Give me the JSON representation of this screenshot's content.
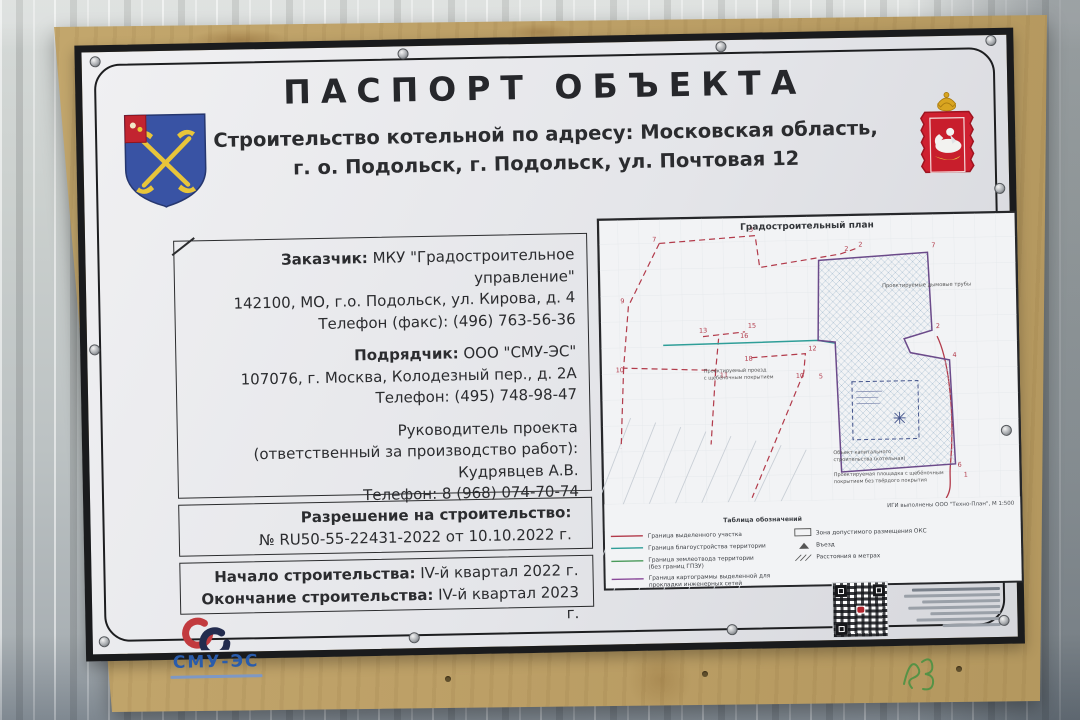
{
  "banner": {
    "title": "ПАСПОРТ ОБЪЕКТА",
    "subtitle_line1": "Строительство котельной по адресу: Московская область,",
    "subtitle_line2": "г. о. Подольск, г. Подольск, ул. Почтовая 12"
  },
  "info": {
    "customer": {
      "label": "Заказчик:",
      "name": "МКУ \"Градостроительное управление\"",
      "address": "142100, МО, г.о. Подольск, ул. Кирова, д. 4",
      "phone": "Телефон (факс): (496) 763-56-36"
    },
    "contractor": {
      "label": "Подрядчик:",
      "name": "ООО \"СМУ-ЭС\"",
      "address": "107076, г. Москва, Колодезный пер., д. 2А",
      "phone": "Телефон: (495) 748-98-47"
    },
    "manager": {
      "line1": "Руководитель проекта",
      "line2": "(ответственный за производство работ):",
      "name": "Кудрявцев А.В.",
      "phone": "Телефон: 8 (968) 074-70-74"
    },
    "permit": {
      "label": "Разрешение на строительство:",
      "value": "№ RU50-55-22431-2022 от 10.10.2022 г."
    },
    "dates": {
      "start_label": "Начало строительства:",
      "start_value": "IV-й квартал 2022 г.",
      "end_label": "Окончание строительства:",
      "end_value": "IV-й квартал 2023 г."
    }
  },
  "plan": {
    "title": "Градостроительный план",
    "note_right": "Проектируемые дымовые трубы",
    "note_road_1": "Проектируемый проезд",
    "note_road_2": "с щебёночным покрытием",
    "note_object_1": "Объект капитального",
    "note_object_2": "строительства (котельная)",
    "note_area_1": "Проектируемая площадка с щебёночным",
    "note_area_2": "покрытием без твёрдого покрытия",
    "scale_note": "ИГИ выполнены ООО \"Техно-План\", М 1:500",
    "legend": {
      "header": "Таблица обозначений",
      "item1": "Граница выделенного участка",
      "item2": "Граница благоустройства территории",
      "item3a": "Граница землеотвода территории",
      "item3b": "(без границ ГПЗУ)",
      "item4a": "Граница картограммы выделенной для",
      "item4b": "прокладки инженерных сетей",
      "right1": "Зона допустимого размещения ОКС",
      "right2": "Въезд",
      "right3": "Расстояния в метрах"
    },
    "points": [
      "7",
      "3",
      "2",
      "2",
      "9",
      "15",
      "16",
      "13",
      "10",
      "11",
      "18",
      "12",
      "10",
      "5",
      "7",
      "2",
      "4",
      "6",
      "1",
      "8"
    ]
  },
  "logo": {
    "name": "СМУ-ЭС"
  },
  "colors": {
    "banner_bg": "#e9eaec",
    "frame_black": "#1a1b1d",
    "plywood_tan": "#bda067",
    "fence_grey": "#c6cbca",
    "boundary_red": "#b23a4a",
    "utility_purple": "#6b4a8a",
    "improvement_teal": "#2f9e98",
    "logo_red": "#c23b3f",
    "logo_navy": "#232c4e",
    "logo_blue": "#2a5cab",
    "arms_blue": "#3953a4",
    "arms_red": "#cf2030",
    "scribble_green": "#3f9140"
  }
}
